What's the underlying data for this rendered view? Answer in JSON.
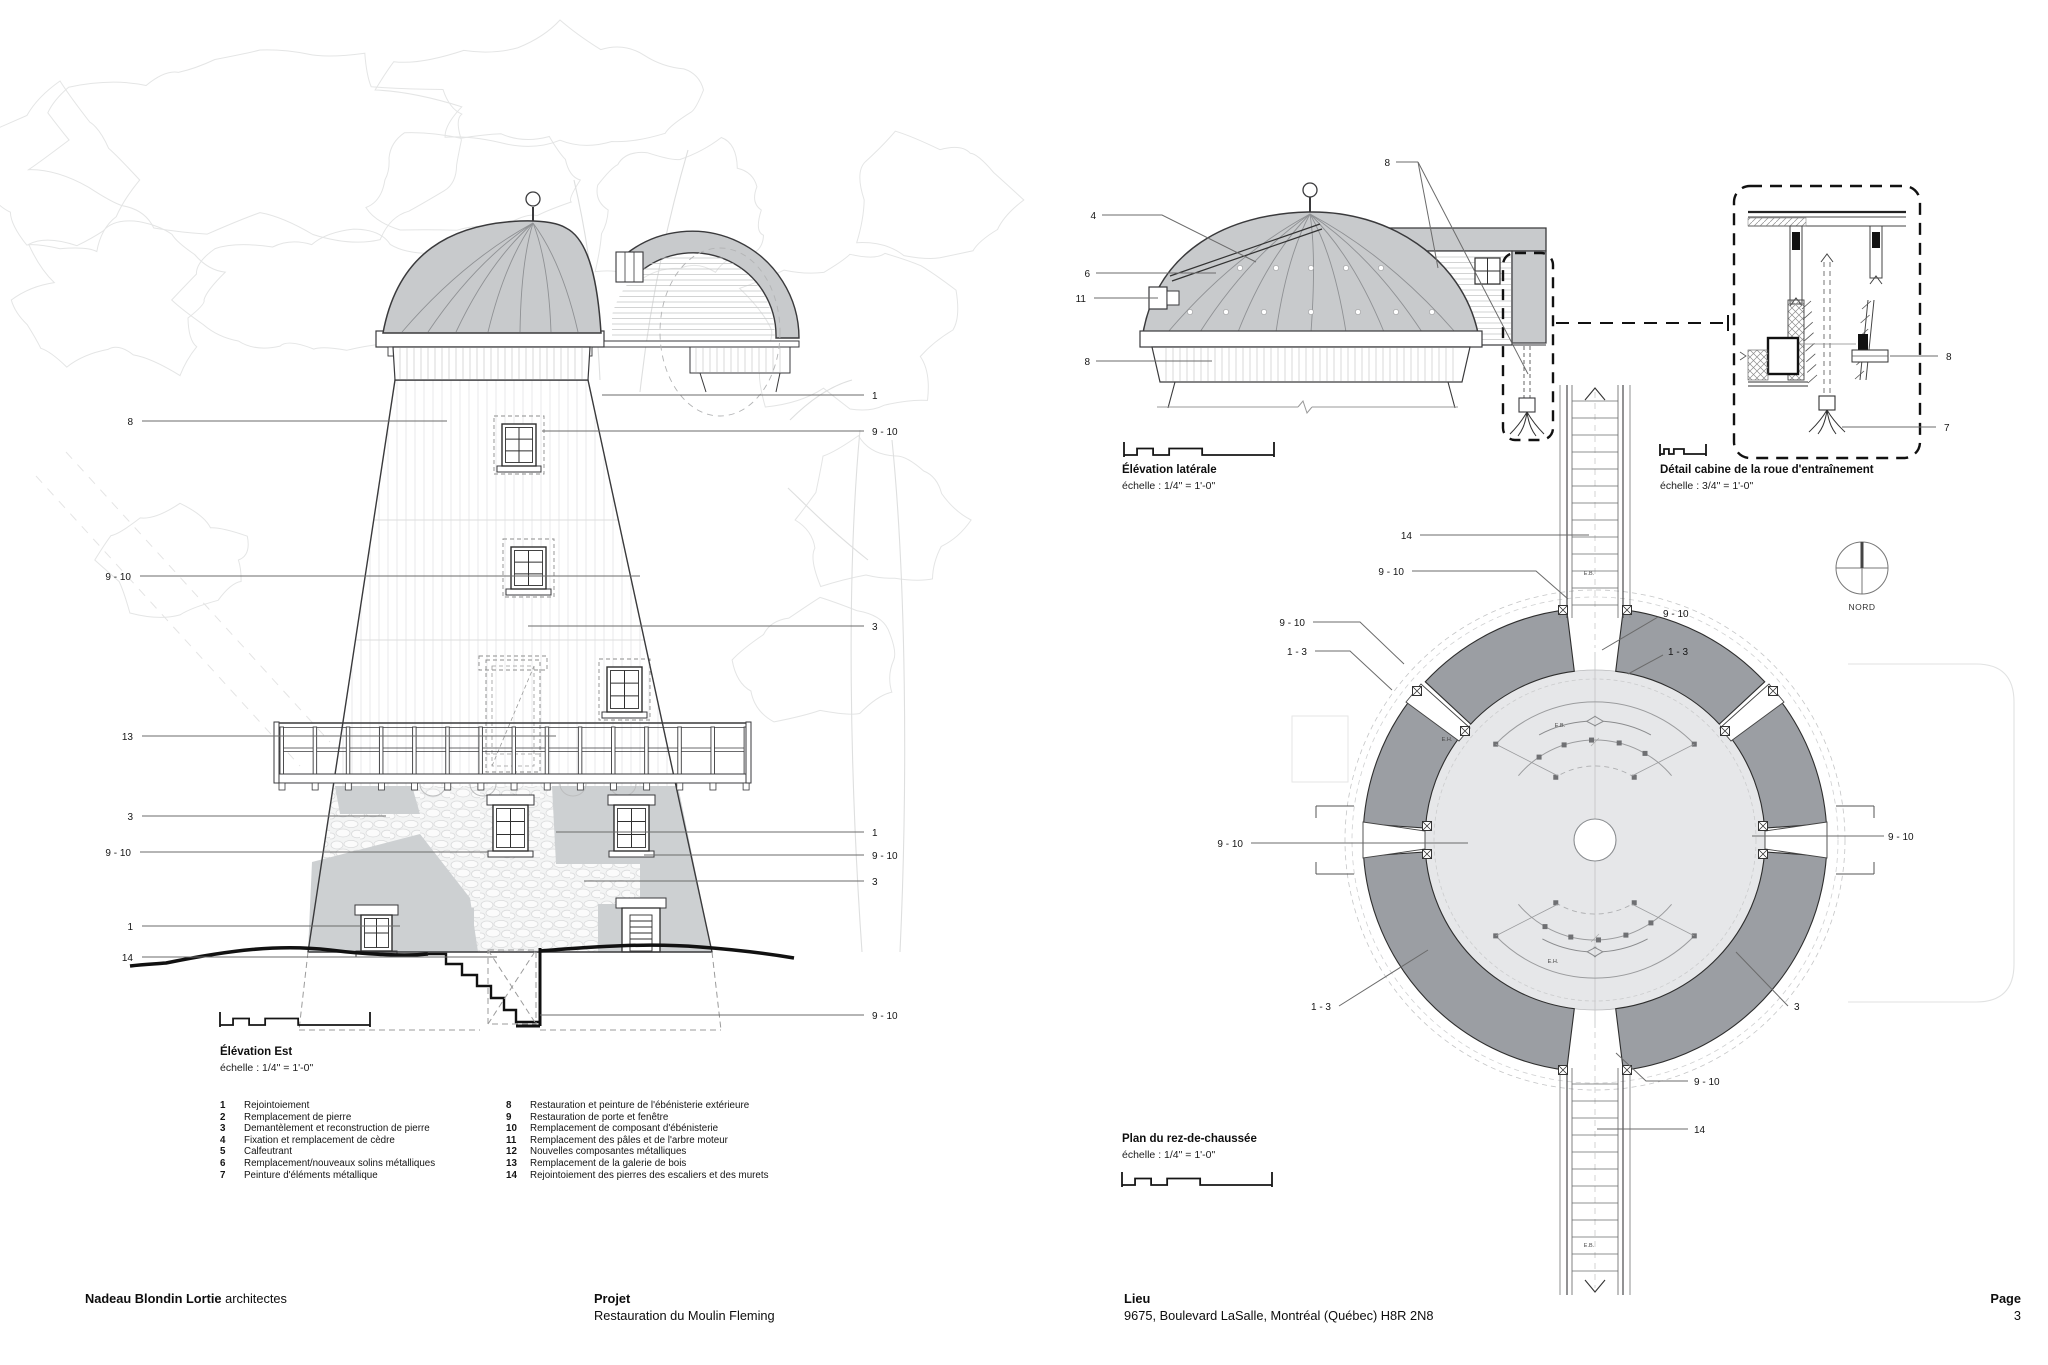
{
  "sheet": {
    "line_color": "#3a3a3c",
    "dome_gray": "#c8cacc",
    "wall_gray": "#9b9ea3",
    "floor_gray": "#e6e7e9",
    "patch_gray": "#cdd0d2"
  },
  "east_elevation": {
    "title": "Élévation Est",
    "scale": "échelle : 1/4\" = 1'-0\"",
    "callouts": [
      {
        "label": "8",
        "x": 133,
        "y": 425,
        "anchor": "end",
        "pts": [
          [
            142,
            421
          ],
          [
            447,
            421
          ]
        ]
      },
      {
        "label": "9 - 10",
        "x": 131,
        "y": 580,
        "anchor": "end",
        "pts": [
          [
            140,
            576
          ],
          [
            640,
            576
          ]
        ]
      },
      {
        "label": "13",
        "x": 133,
        "y": 740,
        "anchor": "end",
        "pts": [
          [
            142,
            736
          ],
          [
            556,
            736
          ]
        ]
      },
      {
        "label": "3",
        "x": 133,
        "y": 820,
        "anchor": "end",
        "pts": [
          [
            142,
            816
          ],
          [
            386,
            816
          ]
        ]
      },
      {
        "label": "9 - 10",
        "x": 131,
        "y": 856,
        "anchor": "end",
        "pts": [
          [
            140,
            852
          ],
          [
            488,
            852
          ]
        ]
      },
      {
        "label": "1",
        "x": 133,
        "y": 930,
        "anchor": "end",
        "pts": [
          [
            142,
            926
          ],
          [
            400,
            926
          ]
        ]
      },
      {
        "label": "14",
        "x": 133,
        "y": 961,
        "anchor": "end",
        "pts": [
          [
            142,
            957
          ],
          [
            497,
            957
          ]
        ]
      },
      {
        "label": "1",
        "x": 872,
        "y": 399,
        "pts": [
          [
            602,
            395
          ],
          [
            864,
            395
          ]
        ]
      },
      {
        "label": "9 - 10",
        "x": 872,
        "y": 435,
        "pts": [
          [
            542,
            431
          ],
          [
            864,
            431
          ]
        ]
      },
      {
        "label": "3",
        "x": 872,
        "y": 630,
        "pts": [
          [
            528,
            626
          ],
          [
            864,
            626
          ]
        ]
      },
      {
        "label": "1",
        "x": 872,
        "y": 836,
        "pts": [
          [
            556,
            832
          ],
          [
            864,
            832
          ]
        ]
      },
      {
        "label": "9 - 10",
        "x": 872,
        "y": 859,
        "pts": [
          [
            644,
            855
          ],
          [
            864,
            855
          ]
        ]
      },
      {
        "label": "3",
        "x": 872,
        "y": 885,
        "pts": [
          [
            584,
            881
          ],
          [
            864,
            881
          ]
        ]
      },
      {
        "label": "9 - 10",
        "x": 872,
        "y": 1019,
        "pts": [
          [
            540,
            1015
          ],
          [
            864,
            1015
          ]
        ]
      }
    ]
  },
  "side_elevation": {
    "title": "Élévation latérale",
    "scale": "échelle : 1/4\" = 1'-0\"",
    "callouts": [
      {
        "label": "8",
        "x": 1390,
        "y": 166,
        "anchor": "end",
        "pts": [
          [
            1396,
            162
          ],
          [
            1418,
            162
          ]
        ]
      },
      {
        "label": "",
        "pts": [
          [
            1418,
            162
          ],
          [
            1438,
            268
          ]
        ]
      },
      {
        "label": "",
        "pts": [
          [
            1418,
            162
          ],
          [
            1528,
            374
          ]
        ]
      },
      {
        "label": "4",
        "x": 1096,
        "y": 219,
        "anchor": "end",
        "pts": [
          [
            1102,
            215
          ],
          [
            1162,
            215
          ],
          [
            1256,
            262
          ]
        ]
      },
      {
        "label": "6",
        "x": 1090,
        "y": 277,
        "anchor": "end",
        "pts": [
          [
            1096,
            273
          ],
          [
            1216,
            273
          ]
        ]
      },
      {
        "label": "11",
        "x": 1086,
        "y": 302,
        "anchor": "end",
        "pts": [
          [
            1094,
            298
          ],
          [
            1158,
            298
          ]
        ]
      },
      {
        "label": "8",
        "x": 1090,
        "y": 365,
        "anchor": "end",
        "pts": [
          [
            1096,
            361
          ],
          [
            1212,
            361
          ]
        ]
      }
    ]
  },
  "detail_view": {
    "title": "Détail cabine de la roue d'entraînement",
    "scale": "échelle : 3/4\" = 1'-0\"",
    "callouts": [
      {
        "label": "8",
        "x": 1946,
        "y": 360,
        "pts": [
          [
            1890,
            356
          ],
          [
            1938,
            356
          ]
        ]
      },
      {
        "label": "7",
        "x": 1944,
        "y": 431,
        "pts": [
          [
            1842,
            427
          ],
          [
            1936,
            427
          ]
        ]
      }
    ]
  },
  "floor_plan": {
    "title": "Plan du rez-de-chaussée",
    "scale": "échelle : 1/4\" = 1'-0\"",
    "north_label": "NORD",
    "stair_labels": [
      {
        "text": "E.B.",
        "x": 1589,
        "y": 575
      },
      {
        "text": "E.B.",
        "x": 1589,
        "y": 1247
      },
      {
        "text": "E.H.",
        "x": 1447,
        "y": 741
      },
      {
        "text": "E.B.",
        "x": 1560,
        "y": 727
      },
      {
        "text": "E.H.",
        "x": 1553,
        "y": 963
      }
    ],
    "callouts": [
      {
        "label": "14",
        "x": 1412,
        "y": 539,
        "anchor": "end",
        "pts": [
          [
            1420,
            535
          ],
          [
            1589,
            535
          ]
        ]
      },
      {
        "label": "9 - 10",
        "x": 1404,
        "y": 575,
        "anchor": "end",
        "pts": [
          [
            1412,
            571
          ],
          [
            1536,
            571
          ],
          [
            1568,
            599
          ]
        ]
      },
      {
        "label": "9 - 10",
        "x": 1305,
        "y": 626,
        "anchor": "end",
        "pts": [
          [
            1313,
            622
          ],
          [
            1360,
            622
          ],
          [
            1404,
            664
          ]
        ]
      },
      {
        "label": "1 - 3",
        "x": 1307,
        "y": 655,
        "anchor": "end",
        "pts": [
          [
            1315,
            651
          ],
          [
            1350,
            651
          ],
          [
            1392,
            690
          ]
        ]
      },
      {
        "label": "9 - 10",
        "x": 1663,
        "y": 617,
        "pts": [
          [
            1658,
            617
          ],
          [
            1602,
            650
          ]
        ]
      },
      {
        "label": "1 - 3",
        "x": 1668,
        "y": 655,
        "pts": [
          [
            1663,
            655
          ],
          [
            1628,
            674
          ]
        ]
      },
      {
        "label": "9 - 10",
        "x": 1243,
        "y": 847,
        "anchor": "end",
        "pts": [
          [
            1251,
            843
          ],
          [
            1468,
            843
          ]
        ]
      },
      {
        "label": "9 - 10",
        "x": 1888,
        "y": 840,
        "pts": [
          [
            1884,
            836
          ],
          [
            1752,
            836
          ]
        ]
      },
      {
        "label": "1 - 3",
        "x": 1331,
        "y": 1010,
        "anchor": "end",
        "pts": [
          [
            1339,
            1006
          ],
          [
            1428,
            950
          ]
        ]
      },
      {
        "label": "3",
        "x": 1794,
        "y": 1010,
        "pts": [
          [
            1788,
            1006
          ],
          [
            1736,
            952
          ]
        ]
      },
      {
        "label": "9 - 10",
        "x": 1694,
        "y": 1085,
        "pts": [
          [
            1688,
            1081
          ],
          [
            1646,
            1081
          ],
          [
            1616,
            1053
          ]
        ]
      },
      {
        "label": "14",
        "x": 1694,
        "y": 1133,
        "pts": [
          [
            1688,
            1129
          ],
          [
            1597,
            1129
          ]
        ]
      }
    ]
  },
  "legend": {
    "items": [
      {
        "num": "1",
        "label": "Rejointoiement"
      },
      {
        "num": "2",
        "label": "Remplacement de pierre"
      },
      {
        "num": "3",
        "label": "Demantèlement et reconstruction de pierre"
      },
      {
        "num": "4",
        "label": "Fixation et remplacement de cèdre"
      },
      {
        "num": "5",
        "label": "Calfeutrant"
      },
      {
        "num": "6",
        "label": "Remplacement/nouveaux solins métalliques"
      },
      {
        "num": "7",
        "label": "Peinture d'éléments métallique"
      },
      {
        "num": "8",
        "label": "Restauration et peinture de l'ébénisterie extérieure"
      },
      {
        "num": "9",
        "label": "Restauration de porte et fenêtre"
      },
      {
        "num": "10",
        "label": "Remplacement de composant d'ébénisterie"
      },
      {
        "num": "11",
        "label": "Remplacement des pâles et de l'arbre moteur"
      },
      {
        "num": "12",
        "label": "Nouvelles composantes métalliques"
      },
      {
        "num": "13",
        "label": "Remplacement de la galerie de bois"
      },
      {
        "num": "14",
        "label": "Rejointoiement des pierres des escaliers et des murets"
      }
    ]
  },
  "footer": {
    "firm_bold": "Nadeau Blondin Lortie",
    "firm_regular": " architectes",
    "project_label": "Projet",
    "project_value": "Restauration du Moulin Fleming",
    "location_label": "Lieu",
    "location_value": "9675, Boulevard LaSalle, Montréal (Québec) H8R 2N8",
    "page_label": "Page",
    "page_value": "3"
  }
}
